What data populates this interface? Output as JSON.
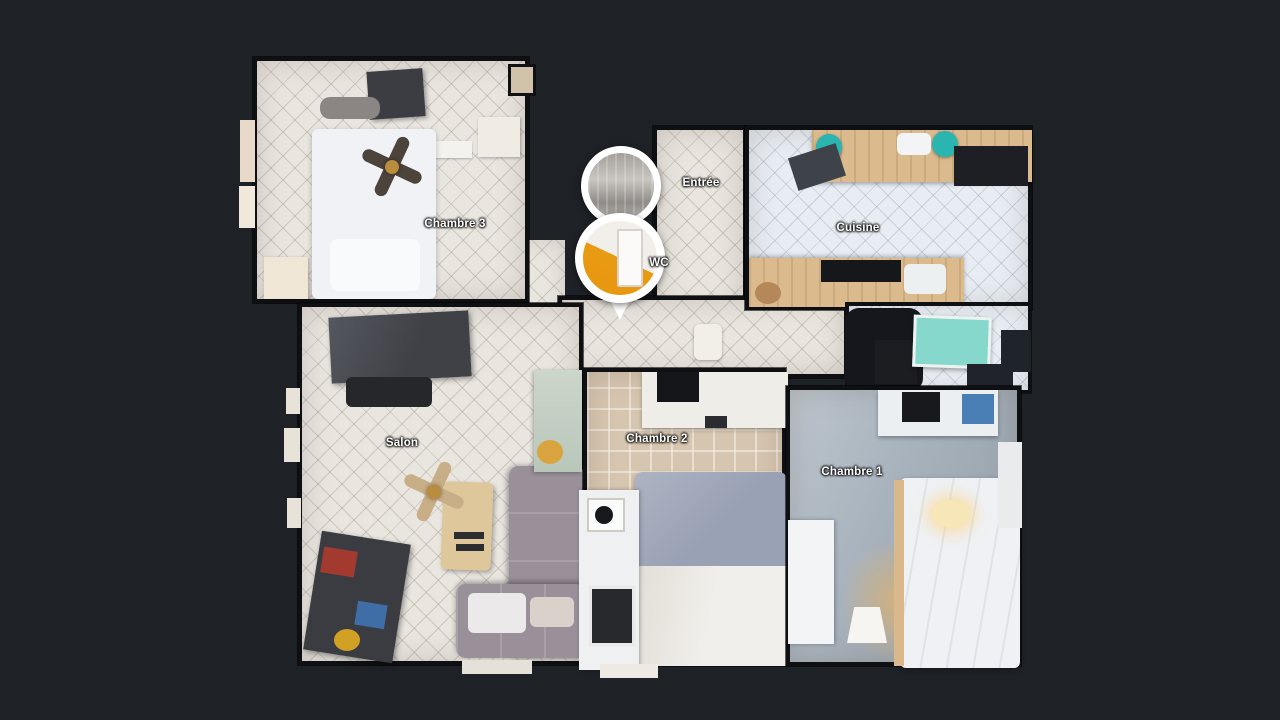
{
  "scene": {
    "view": "3D dollhouse floor plan",
    "background_color": "#1e2126",
    "wall_color": "#0e1014",
    "label_color": "#ffffff",
    "marker_ring_color": "#ffffff",
    "wc_photo_wall_color": "#e89b12",
    "kitchen_stool_color": "#2ab5b0",
    "kitchen_table_color": "#85d8cb"
  },
  "rooms": [
    {
      "id": "chambre-3",
      "label": "Chambre 3"
    },
    {
      "id": "entree",
      "label": "Entrée"
    },
    {
      "id": "cuisine",
      "label": "Cuisine"
    },
    {
      "id": "wc",
      "label": "WC"
    },
    {
      "id": "salon",
      "label": "Salon"
    },
    {
      "id": "chambre-2",
      "label": "Chambre 2"
    },
    {
      "id": "chambre-1",
      "label": "Chambre 1"
    }
  ],
  "markers": [
    {
      "id": "marker-entree",
      "room": "Entrée",
      "type": "panorama-photo-pin"
    },
    {
      "id": "marker-wc",
      "room": "WC",
      "type": "panorama-photo-pin",
      "pointer": true
    }
  ]
}
